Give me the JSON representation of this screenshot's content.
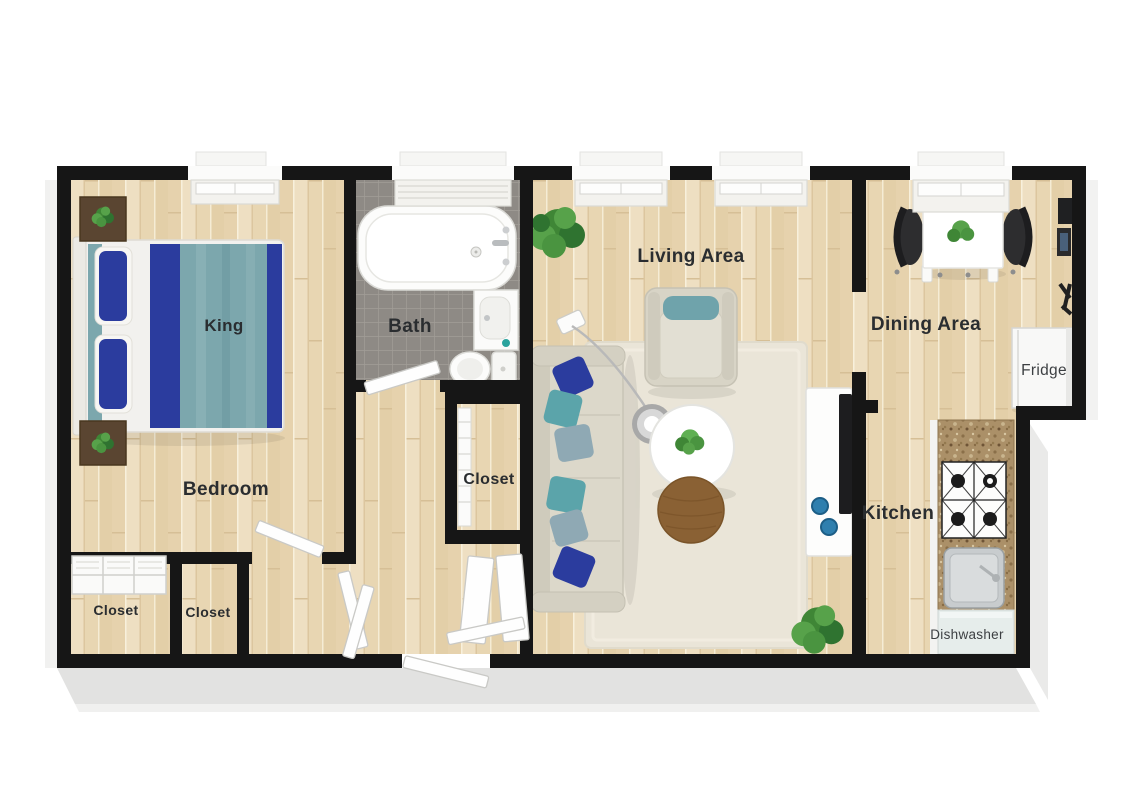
{
  "labels": {
    "bedroom": "Bedroom",
    "bed_size": "King",
    "bath": "Bath",
    "hall_closet": "Closet",
    "closet_left": "Closet",
    "closet_right": "Closet",
    "living_area": "Living Area",
    "dining_area": "Dining Area",
    "kitchen": "Kitchen",
    "fridge": "Fridge",
    "dishwasher": "Dishwasher"
  },
  "palette": {
    "wall": "#161616",
    "wood_floor": "#e9d8b8",
    "bath_tile": "#8e8a85",
    "rug": "#eae5d8",
    "bedding_navy": "#2b3c9e",
    "bedding_teal": "#7ca7ad",
    "sofa_beige": "#dcd8ca",
    "counter_granite": "#ab9068",
    "plant_green": "#3f8636",
    "label_text": "#2a2d30"
  }
}
